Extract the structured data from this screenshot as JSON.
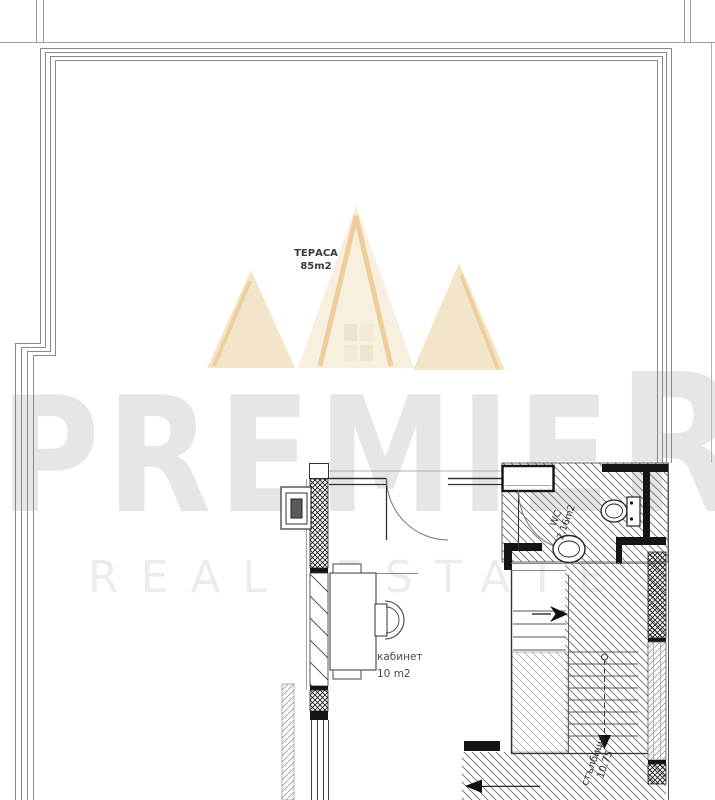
{
  "brand": {
    "name_main": "PREMIE",
    "name_last_letter": "R",
    "tagline": "REAL ESTATE",
    "watermark_text_color": "#e7e5e8",
    "tagline_color": "#ecebee",
    "crown_cream": "#f8efdc",
    "crown_tan": "#f1e0bf",
    "crown_gold": "#ecc488"
  },
  "rooms": {
    "terrace": {
      "label": "ТЕРАСА",
      "area": "85m2"
    },
    "office": {
      "label": "кабинет",
      "area": "10 m2"
    },
    "wc": {
      "label": "WC",
      "area": "2.16m2"
    },
    "staircase": {
      "label": "стълбище",
      "area": "10.75"
    }
  },
  "plan": {
    "line_color": "#3c3c3c",
    "wall_fill": "#141414",
    "hatch_color": "#6e6e6e",
    "label_color": "#3f3f3f"
  }
}
